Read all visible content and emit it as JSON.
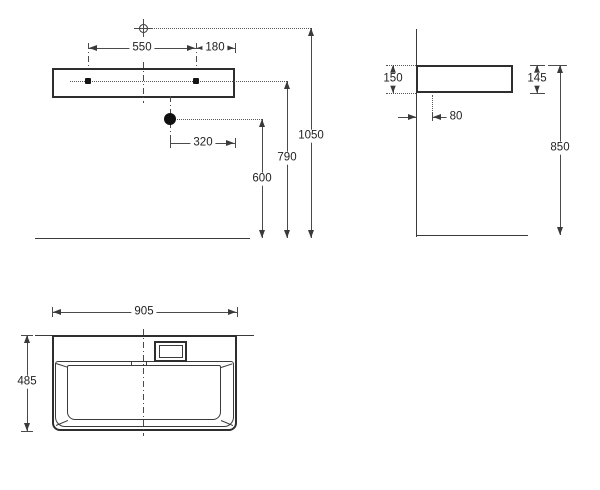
{
  "colors": {
    "line": "#3a3a3a",
    "dim_line": "#4a4a4a",
    "text": "#1f1f1f",
    "background": "#ffffff"
  },
  "symbols": {
    "mount_marker": "crosshair-circle-icon",
    "drain_marker": "filled-circle",
    "fixing_hole_marker": "small-filled-square"
  },
  "views": {
    "front": {
      "dims": {
        "hole_spacing": "550",
        "hole_to_edge": "180",
        "drain_to_edge": "320",
        "drain_height": "600",
        "hole_height": "790",
        "mount_height": "1050"
      }
    },
    "side": {
      "dims": {
        "back_height": "150",
        "front_height": "145",
        "drain_wall_offset": "80",
        "rim_height": "850"
      }
    },
    "plan": {
      "dims": {
        "width": "905",
        "depth": "485"
      }
    }
  }
}
